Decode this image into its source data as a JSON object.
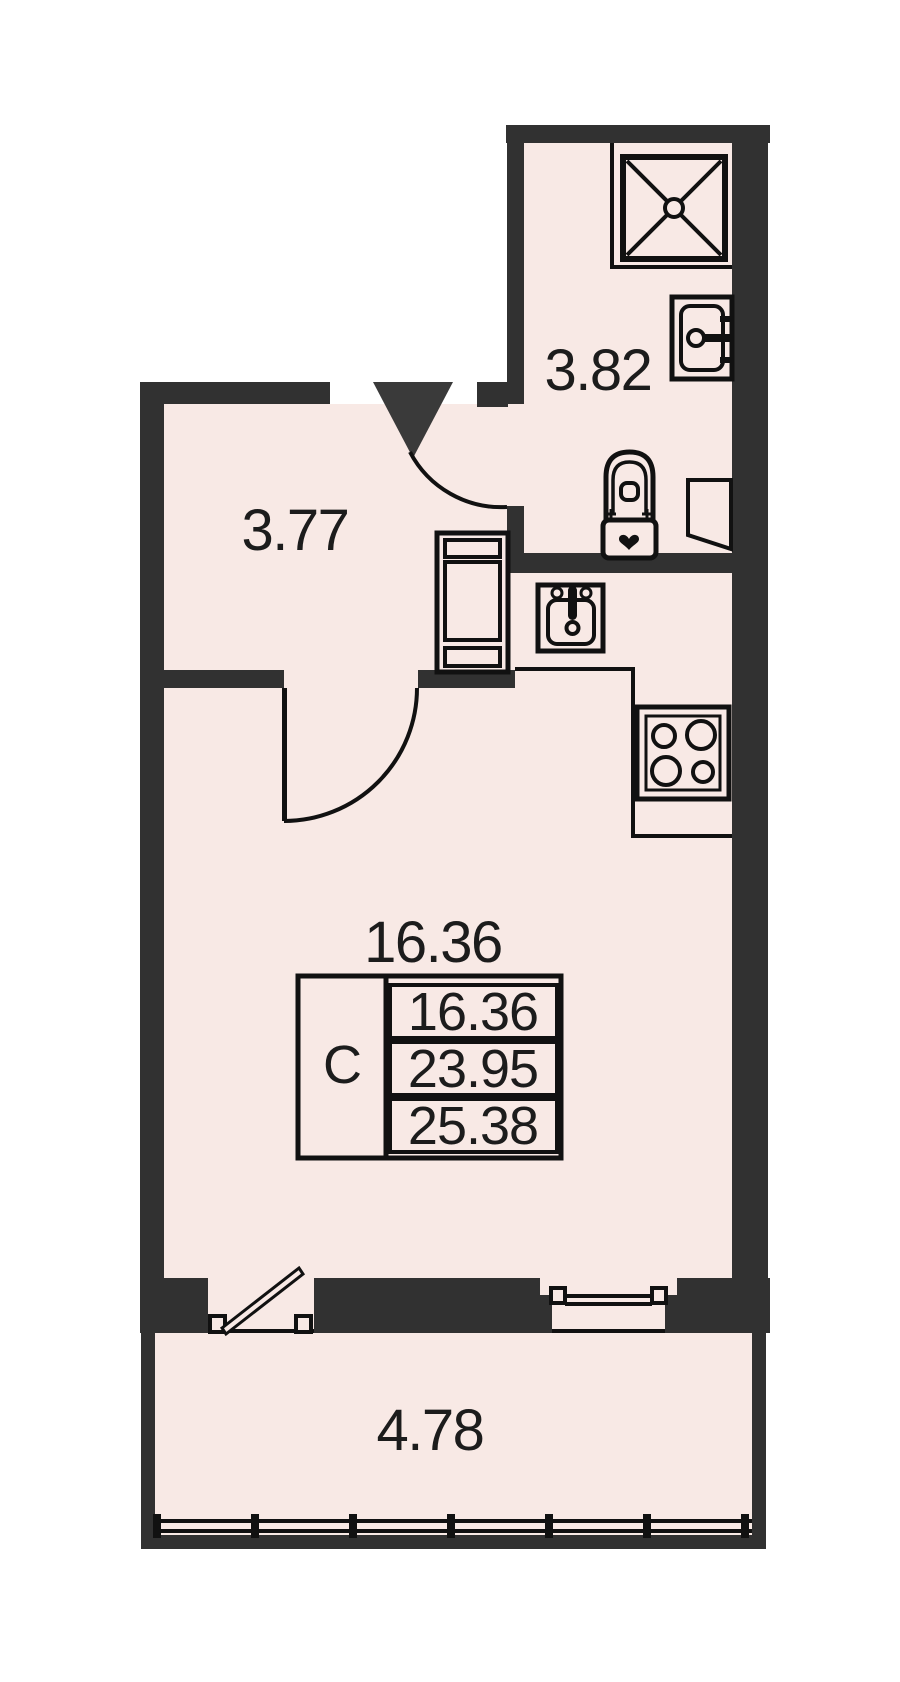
{
  "colors": {
    "background": "#ffffff",
    "wall": "#313131",
    "room_fill": "#f8e9e5",
    "line": "#111111",
    "text": "#1c1c1c",
    "entrance_marker": "#3a3a3a"
  },
  "rooms": {
    "hallway": {
      "area": "3.77"
    },
    "bathroom": {
      "area": "3.82"
    },
    "living_room": {
      "area": "16.36"
    },
    "balcony": {
      "area": "4.78"
    }
  },
  "area_table": {
    "type_label": "С",
    "rows": [
      "16.36",
      "23.95",
      "25.38"
    ]
  },
  "fixtures": [
    "shower-tray-icon",
    "washbasin-icon",
    "toilet-icon",
    "ventilation-shaft-icon",
    "kitchen-sink-icon",
    "stove-icon",
    "wardrobe-icon",
    "entrance-triangle-icon",
    "door-swing-arc",
    "balcony-door-icon",
    "window-icon",
    "balcony-glazing-icon"
  ]
}
